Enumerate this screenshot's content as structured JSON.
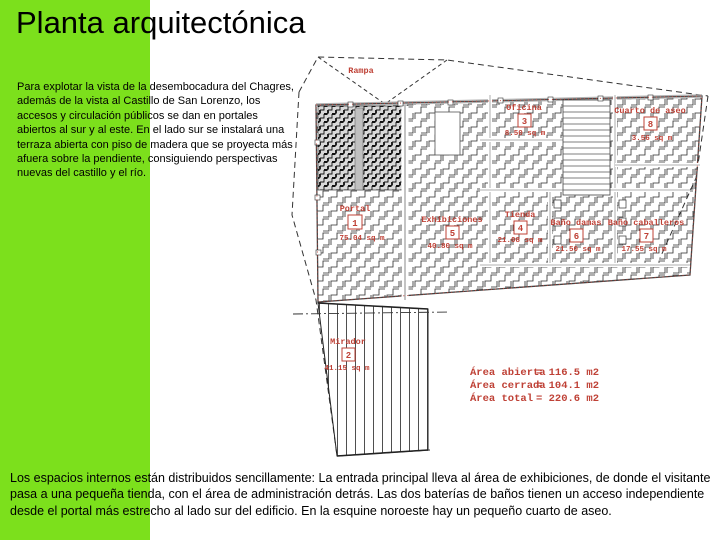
{
  "slide": {
    "title": "Planta arquitectónica",
    "intro_text": "Para explotar la vista de la desembocadura del Chagres, además de la vista al Castillo de San Lorenzo, los accesos y circulación públicos se dan en portales abiertos al sur y al este. En el lado sur se instalará una terraza abierta con piso de madera que se proyecta más afuera sobre la pendiente, consiguiendo perspectivas nuevas del castillo y el río.",
    "footer_text": "Los espacios internos están distribuidos sencillamente: La entrada principal lleva al área de exhibiciones, de donde el visitante pasa a una pequeña tienda, con el área de administración detrás. Las dos baterías de baños tienen un acceso independiente desde el portal más estrecho al lado sur del edificio. En la esquine noroeste hay un pequeño cuarto de aseo.",
    "colors": {
      "background_green": "#7ce01c",
      "panel_white": "#ffffff",
      "plan_red": "#bf4136",
      "line_black": "#1a1a1a"
    }
  },
  "plan": {
    "ramp_label": "Rampa",
    "rooms": [
      {
        "number": "1",
        "name": "Portal",
        "area": "75.04 sq m"
      },
      {
        "number": "2",
        "name": "Mirador",
        "area": "41.15 sq m"
      },
      {
        "number": "3",
        "name": "Oficina",
        "area": "8.50 sq m"
      },
      {
        "number": "4",
        "name": "Tienda",
        "area": "21.08 sq m"
      },
      {
        "number": "5",
        "name": "Exhibiciones",
        "area": "40.80 sq m"
      },
      {
        "number": "6",
        "name": "Baño damas",
        "area": "21.50 sq m"
      },
      {
        "number": "7",
        "name": "Baño caballeros",
        "area": "17.55 sq m"
      },
      {
        "number": "8",
        "name": "Cuarto de aseo",
        "area": "3.56 sq m"
      }
    ],
    "summary": [
      {
        "label": "Área abierta",
        "value": "= 116.5 m2"
      },
      {
        "label": "Área cerrada",
        "value": "= 104.1 m2"
      },
      {
        "label": "Área total",
        "value": "= 220.6 m2"
      }
    ]
  }
}
